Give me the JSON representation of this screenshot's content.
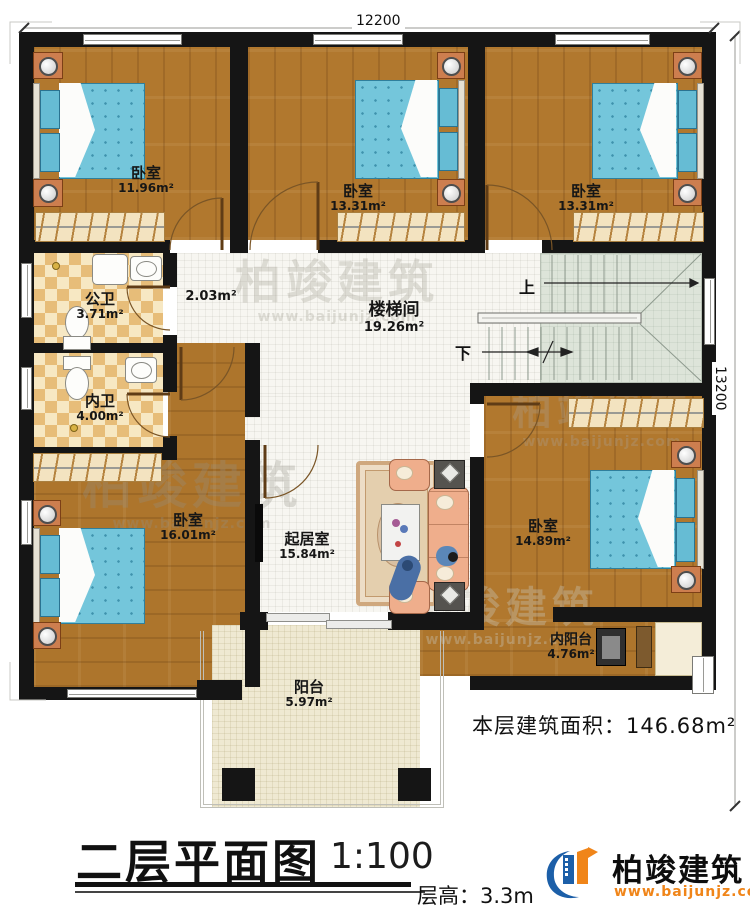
{
  "dimensions": {
    "top": "12200",
    "right": "13200"
  },
  "rooms": [
    {
      "name": "卧室",
      "area": "11.96m²"
    },
    {
      "name": "卧室",
      "area": "13.31m²"
    },
    {
      "name": "卧室",
      "area": "13.31m²"
    },
    {
      "name": "公卫",
      "area": "3.71m²"
    },
    {
      "name": "内卫",
      "area": "4.00m²"
    },
    {
      "name": "",
      "area": "2.03m²"
    },
    {
      "name": "楼梯间",
      "area": "19.26m²"
    },
    {
      "name": "卧室",
      "area": "16.01m²"
    },
    {
      "name": "起居室",
      "area": "15.84m²"
    },
    {
      "name": "卧室",
      "area": "14.89m²"
    },
    {
      "name": "内阳台",
      "area": "4.76m²"
    },
    {
      "name": "阳台",
      "area": "5.97m²"
    }
  ],
  "stairs": {
    "up_label": "上",
    "down_label": "下"
  },
  "titleblock": {
    "floor_area_label": "本层建筑面积：146.68m²",
    "title": "二层平面图",
    "scale": "1:100",
    "floor_height": "层高：3.3m"
  },
  "logo": {
    "name": "柏竣建筑",
    "url": "www.baijunjz.com"
  },
  "watermark": {
    "name": "柏竣建筑",
    "url": "www.baijunjz.com"
  },
  "colors": {
    "wall": "#151515",
    "wood": "#b1782e",
    "white_tile": "#f7f6f1",
    "bath_tile_dark": "#e7bd79",
    "bath_tile_light": "#f7e8c3",
    "stair_tile": "#dde4d9",
    "balcony_tile": "#efe9d2",
    "bed_blue": "#74c6db",
    "sofa_salmon": "#efae8c",
    "logo_blue": "#1c5fa8",
    "logo_orange": "#f08519"
  }
}
